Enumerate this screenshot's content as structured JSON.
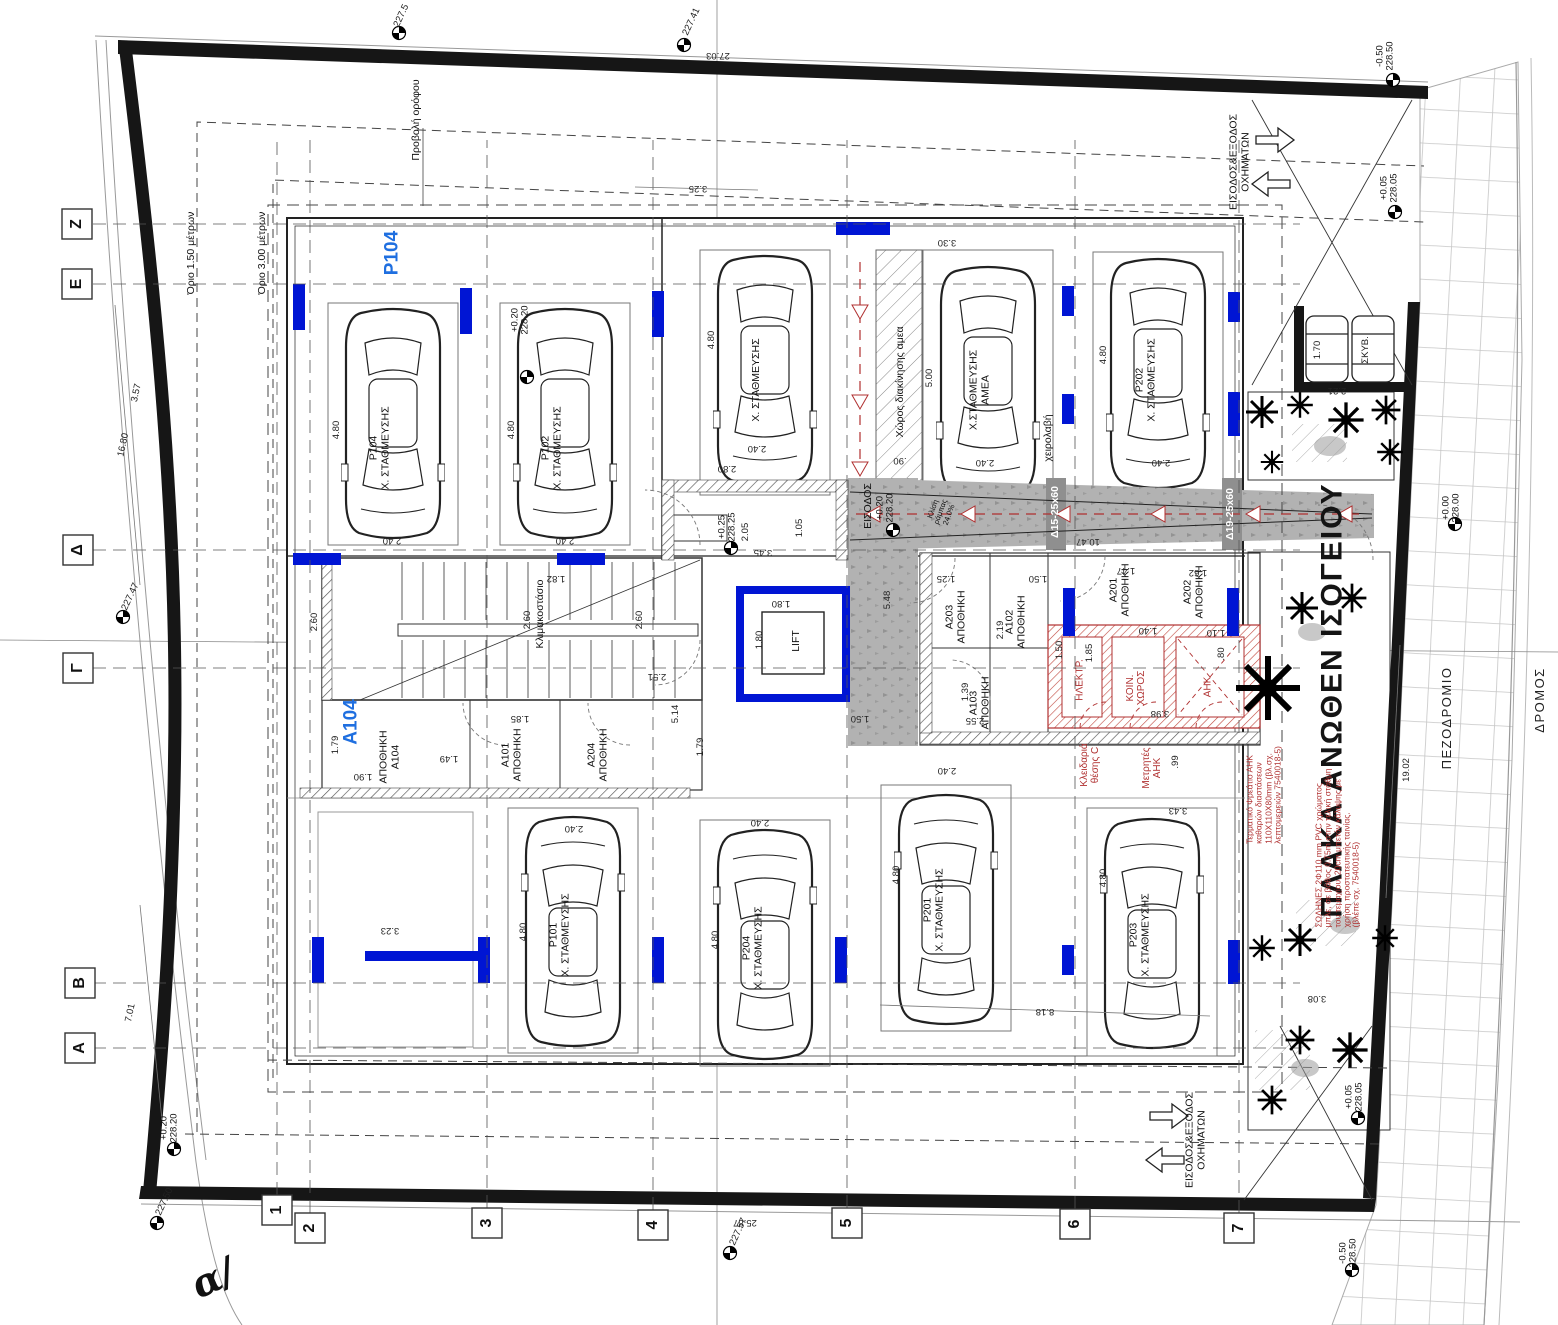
{
  "drawing_type": "architectural-ground-floor-parking-plan",
  "labels": [
    {
      "t": "Ζ",
      "x": 77,
      "y": 224,
      "r": -90,
      "c": "a",
      "n": "grid-axis-z"
    },
    {
      "t": "Ε",
      "x": 77,
      "y": 284,
      "r": -90,
      "c": "a",
      "n": "grid-axis-e"
    },
    {
      "t": "Δ",
      "x": 78,
      "y": 550,
      "r": -90,
      "c": "a",
      "n": "grid-axis-d"
    },
    {
      "t": "Γ",
      "x": 78,
      "y": 668,
      "r": -90,
      "c": "a",
      "n": "grid-axis-g"
    },
    {
      "t": "Β",
      "x": 80,
      "y": 983,
      "r": -90,
      "c": "a",
      "n": "grid-axis-b"
    },
    {
      "t": "Α",
      "x": 80,
      "y": 1048,
      "r": -90,
      "c": "a",
      "n": "grid-axis-a"
    },
    {
      "t": "1",
      "x": 277,
      "y": 1210,
      "r": -90,
      "c": "a",
      "n": "grid-axis-1"
    },
    {
      "t": "2",
      "x": 310,
      "y": 1228,
      "r": -90,
      "c": "a",
      "n": "grid-axis-2"
    },
    {
      "t": "3",
      "x": 487,
      "y": 1223,
      "r": -90,
      "c": "a",
      "n": "grid-axis-3"
    },
    {
      "t": "4",
      "x": 653,
      "y": 1225,
      "r": -90,
      "c": "a",
      "n": "grid-axis-4"
    },
    {
      "t": "5",
      "x": 847,
      "y": 1223,
      "r": -90,
      "c": "a",
      "n": "grid-axis-5"
    },
    {
      "t": "6",
      "x": 1075,
      "y": 1224,
      "r": -90,
      "c": "a",
      "n": "grid-axis-6"
    },
    {
      "t": "7",
      "x": 1239,
      "y": 1228,
      "r": -90,
      "c": "a",
      "n": "grid-axis-7"
    },
    {
      "t": "Όριο 1.50 μέτρων",
      "x": 192,
      "y": 253,
      "r": -90,
      "c": "t",
      "n": "setback-1-50"
    },
    {
      "t": "Όριο 3.00 μέτρων",
      "x": 263,
      "y": 253,
      "r": -90,
      "c": "t",
      "n": "setback-3-00"
    },
    {
      "t": "Προβολή ορόφου",
      "x": 417,
      "y": 120,
      "r": -90,
      "c": "t",
      "n": "floor-projection"
    },
    {
      "t": "P104",
      "x": 393,
      "y": 253,
      "r": -90,
      "c": "b",
      "n": "unit-p104"
    },
    {
      "t": "A104",
      "x": 352,
      "y": 722,
      "r": -90,
      "c": "b",
      "n": "unit-a104"
    },
    {
      "t": "ΠΛΑΚΑ ΑΝΩΘΕΝ ΙΣΟΓΕΙΟΥ",
      "x": 1332,
      "y": 700,
      "r": -90,
      "c": "g",
      "n": "slab-above-ground-floor"
    },
    {
      "t": "ΠΕΖΟΔΡΟΜΙΟ",
      "x": 1447,
      "y": 718,
      "r": -90,
      "c": "t2",
      "n": "sidewalk-label"
    },
    {
      "t": "ΔΡΟΜΟΣ",
      "x": 1540,
      "y": 700,
      "r": -90,
      "c": "t2",
      "n": "road-label"
    },
    {
      "t": "α/",
      "x": 213,
      "y": 1278,
      "r": -25,
      "c": "i",
      "n": "street-name-fragment"
    },
    {
      "t": "ΕΙΣΟΔΟΣ&ΕΞΟΔΟΣ\nΟΧΗΜΑΤΩΝ",
      "x": 1240,
      "y": 162,
      "r": -90,
      "c": "t",
      "n": "vehicle-entry-exit-top"
    },
    {
      "t": "ΕΙΣΟΔΟΣ&ΕΞΟΔΟΣ\nΟΧΗΜΑΤΩΝ",
      "x": 1196,
      "y": 1140,
      "r": -90,
      "c": "t",
      "n": "vehicle-entry-exit-bottom"
    },
    {
      "t": "ΕΙΣΟΔΟΣ",
      "x": 869,
      "y": 506,
      "r": -90,
      "c": "t",
      "n": "entrance-label"
    },
    {
      "t": "Κλιμακοστάσιο",
      "x": 541,
      "y": 614,
      "r": -90,
      "c": "t",
      "n": "staircase-label"
    },
    {
      "t": "LIFT",
      "x": 797,
      "y": 641,
      "r": -90,
      "c": "t",
      "n": "lift-label"
    },
    {
      "t": "χειρολαβή",
      "x": 1049,
      "y": 438,
      "r": -90,
      "c": "t",
      "n": "handrail-label"
    },
    {
      "t": "Χώρος διακίνησης αμεα",
      "x": 901,
      "y": 382,
      "r": -90,
      "c": "t",
      "n": "amea-maneuver-zone"
    },
    {
      "t": "Κλίση\nράμπας\n24.0%",
      "x": 941,
      "y": 512,
      "r": -70,
      "c": "xs",
      "n": "ramp-slope"
    },
    {
      "t": "Δ15-25x60",
      "x": 1056,
      "y": 512,
      "r": -90,
      "c": "w",
      "n": "beam-d15"
    },
    {
      "t": "Δ19-25x60",
      "x": 1231,
      "y": 514,
      "r": -90,
      "c": "w",
      "n": "beam-d19"
    },
    {
      "t": "P104\nΧ. ΣΤΑΘΜΕΥΣΗΣ",
      "x": 380,
      "y": 448,
      "r": -90,
      "c": "t",
      "n": "parking-p104"
    },
    {
      "t": "P102\nΧ. ΣΤΑΘΜΕΥΣΗΣ",
      "x": 552,
      "y": 448,
      "r": -90,
      "c": "t",
      "n": "parking-p102"
    },
    {
      "t": "Χ. ΣΤΑΘΜΕΥΣΗΣ",
      "x": 757,
      "y": 380,
      "r": -90,
      "c": "t",
      "n": "parking-p103"
    },
    {
      "t": "Χ.ΣΤΑΘΜΕΥΣΗΣ\nΑΜΕΑ",
      "x": 980,
      "y": 390,
      "r": -90,
      "c": "t",
      "n": "parking-amea"
    },
    {
      "t": "P202\nΧ. ΣΤΑΘΜΕΥΣΗΣ",
      "x": 1146,
      "y": 380,
      "r": -90,
      "c": "t",
      "n": "parking-p202"
    },
    {
      "t": "P101\nΧ. ΣΤΑΘΜΕΥΣΗΣ",
      "x": 560,
      "y": 935,
      "r": -90,
      "c": "t",
      "n": "parking-p101"
    },
    {
      "t": "P204\nΧ. ΣΤΑΘΜΕΥΣΗΣ",
      "x": 753,
      "y": 948,
      "r": -90,
      "c": "t",
      "n": "parking-p204"
    },
    {
      "t": "P201\nΧ. ΣΤΑΘΜΕΥΣΗΣ",
      "x": 934,
      "y": 910,
      "r": -90,
      "c": "t",
      "n": "parking-p201"
    },
    {
      "t": "P203\nΧ. ΣΤΑΘΜΕΥΣΗΣ",
      "x": 1140,
      "y": 935,
      "r": -90,
      "c": "t",
      "n": "parking-p203"
    },
    {
      "t": "ΑΠΟΘΗΚΗ\nA104",
      "x": 390,
      "y": 757,
      "r": -90,
      "c": "t",
      "n": "storage-a104"
    },
    {
      "t": "A101\nΑΠΟΘΗΚΗ",
      "x": 512,
      "y": 755,
      "r": -90,
      "c": "t",
      "n": "storage-a101"
    },
    {
      "t": "A204\nΑΠΟΘΗΚΗ",
      "x": 598,
      "y": 755,
      "r": -90,
      "c": "t",
      "n": "storage-a204"
    },
    {
      "t": "A203\nΑΠΟΘΗΚΗ",
      "x": 956,
      "y": 617,
      "r": -90,
      "c": "t",
      "n": "storage-a203"
    },
    {
      "t": "A102\nΑΠΟΘΗΚΗ",
      "x": 1016,
      "y": 622,
      "r": -90,
      "c": "t",
      "n": "storage-a102"
    },
    {
      "t": "A103\nΑΠΟΘΗΚΗ",
      "x": 980,
      "y": 703,
      "r": -90,
      "c": "t",
      "n": "storage-a103"
    },
    {
      "t": "A201\nΑΠΟΘΗΚΗ",
      "x": 1120,
      "y": 590,
      "r": -90,
      "c": "t",
      "n": "storage-a201"
    },
    {
      "t": "A202\nΑΠΟΘΗΚΗ",
      "x": 1194,
      "y": 592,
      "r": -90,
      "c": "t",
      "n": "storage-a202"
    },
    {
      "t": "ΗΛΕΚΤΡ.",
      "x": 1080,
      "y": 680,
      "r": -90,
      "c": "r",
      "n": "room-electrical"
    },
    {
      "t": "ΚΟΙΝ.\nΧΩΡΟΣ",
      "x": 1136,
      "y": 688,
      "r": -90,
      "c": "r",
      "n": "room-common-space"
    },
    {
      "t": "ΑΗΚ",
      "x": 1208,
      "y": 687,
      "r": -90,
      "c": "r",
      "n": "room-ahk"
    },
    {
      "t": "Κλειδαριά\nθέσης C",
      "x": 1090,
      "y": 765,
      "r": -90,
      "c": "r",
      "n": "note-lock-position-c"
    },
    {
      "t": "Μετρητές\nΑΗΚ",
      "x": 1152,
      "y": 768,
      "r": -90,
      "c": "r",
      "n": "note-ahk-meters"
    },
    {
      "t": "Τερματικό Φρεάτιο ΑΗΚ\nκαθαρών διαστάσεων\n110X110X80mm (βλ.σχ.\nλεπτομερειών 7540018-5)",
      "x": 1264,
      "y": 795,
      "r": -90,
      "c": "rs",
      "n": "note-ahk-pit"
    },
    {
      "t": "ΣΩΛΗΝΕΣ 2Φ110 mm PVC χρώματος\nμπλε, σε βάθος 0.75m στην τελική στάθμη\nτου τεμαχίου, 20cm μπετόν κάλυψης με\nχρήση προστατευτικής ταινίας.\n(βλέπε σχ. 7540018-5)",
      "x": 1338,
      "y": 848,
      "r": -90,
      "c": "rs",
      "n": "note-pvc-pipes"
    },
    {
      "t": "1.70",
      "x": 1318,
      "y": 350,
      "r": -90,
      "c": "d"
    },
    {
      "t": "ΣΚΥΒ.",
      "x": 1366,
      "y": 350,
      "r": -90,
      "c": "d",
      "n": "bins-label"
    },
    {
      "t": "2.21",
      "x": 1337,
      "y": 390,
      "r": 180,
      "c": "d"
    },
    {
      "t": "27.03",
      "x": 718,
      "y": 55,
      "r": 180,
      "c": "d"
    },
    {
      "t": "3.25",
      "x": 698,
      "y": 188,
      "r": 180,
      "c": "d"
    },
    {
      "t": "3.30",
      "x": 947,
      "y": 242,
      "r": 180,
      "c": "d"
    },
    {
      "t": "16.80",
      "x": 124,
      "y": 445,
      "r": -78,
      "c": "d"
    },
    {
      "t": "3.57",
      "x": 137,
      "y": 393,
      "r": -78,
      "c": "d"
    },
    {
      "t": "7.01",
      "x": 131,
      "y": 1013,
      "r": -78,
      "c": "d"
    },
    {
      "t": "25.87",
      "x": 745,
      "y": 1222,
      "r": 180,
      "c": "d"
    },
    {
      "t": "8.18",
      "x": 1045,
      "y": 1011,
      "r": 180,
      "c": "d"
    },
    {
      "t": "19.02",
      "x": 1407,
      "y": 770,
      "r": -90,
      "c": "d"
    },
    {
      "t": "10.47",
      "x": 1088,
      "y": 541,
      "r": 180,
      "c": "d"
    },
    {
      "t": "4.80",
      "x": 337,
      "y": 430,
      "r": -90,
      "c": "d"
    },
    {
      "t": "2.40",
      "x": 392,
      "y": 540,
      "r": 180,
      "c": "d"
    },
    {
      "t": "4.80",
      "x": 512,
      "y": 430,
      "r": -90,
      "c": "d"
    },
    {
      "t": "2.40",
      "x": 565,
      "y": 540,
      "r": 180,
      "c": "d"
    },
    {
      "t": "4.80",
      "x": 712,
      "y": 340,
      "r": -90,
      "c": "d"
    },
    {
      "t": "2.40",
      "x": 757,
      "y": 448,
      "r": 180,
      "c": "d"
    },
    {
      "t": "2.80",
      "x": 727,
      "y": 468,
      "r": 180,
      "c": "d"
    },
    {
      "t": "5.00",
      "x": 930,
      "y": 378,
      "r": -90,
      "c": "d"
    },
    {
      "t": "2.40",
      "x": 985,
      "y": 462,
      "r": 180,
      "c": "d"
    },
    {
      "t": ".90",
      "x": 900,
      "y": 460,
      "r": 180,
      "c": "d"
    },
    {
      "t": "4.80",
      "x": 1104,
      "y": 355,
      "r": -90,
      "c": "d"
    },
    {
      "t": "2.40",
      "x": 1161,
      "y": 462,
      "r": 180,
      "c": "d"
    },
    {
      "t": "4.80",
      "x": 524,
      "y": 932,
      "r": -90,
      "c": "d"
    },
    {
      "t": "2.40",
      "x": 574,
      "y": 828,
      "r": 180,
      "c": "d"
    },
    {
      "t": "4.80",
      "x": 716,
      "y": 940,
      "r": -90,
      "c": "d"
    },
    {
      "t": "2.40",
      "x": 760,
      "y": 822,
      "r": 180,
      "c": "d"
    },
    {
      "t": "4.80",
      "x": 897,
      "y": 875,
      "r": -90,
      "c": "d"
    },
    {
      "t": "2.40",
      "x": 947,
      "y": 770,
      "r": 180,
      "c": "d"
    },
    {
      "t": "4.80",
      "x": 1104,
      "y": 878,
      "r": -90,
      "c": "d"
    },
    {
      "t": "3.43",
      "x": 1178,
      "y": 810,
      "r": 180,
      "c": "d"
    },
    {
      "t": "3.23",
      "x": 390,
      "y": 930,
      "r": 180,
      "c": "d"
    },
    {
      "t": "3.08",
      "x": 1317,
      "y": 998,
      "r": 180,
      "c": "d"
    },
    {
      "t": "2.60",
      "x": 315,
      "y": 622,
      "r": -90,
      "c": "d"
    },
    {
      "t": "2.60",
      "x": 528,
      "y": 620,
      "r": -90,
      "c": "d"
    },
    {
      "t": "2.60",
      "x": 640,
      "y": 620,
      "r": -90,
      "c": "d"
    },
    {
      "t": "1.82",
      "x": 556,
      "y": 578,
      "r": 180,
      "c": "d"
    },
    {
      "t": "2.51",
      "x": 657,
      "y": 676,
      "r": 180,
      "c": "d"
    },
    {
      "t": "5.14",
      "x": 676,
      "y": 714,
      "r": -90,
      "c": "d"
    },
    {
      "t": "1.80",
      "x": 781,
      "y": 603,
      "r": 180,
      "c": "d"
    },
    {
      "t": "1.80",
      "x": 760,
      "y": 640,
      "r": -90,
      "c": "d"
    },
    {
      "t": "1.79",
      "x": 336,
      "y": 745,
      "r": -90,
      "c": "d"
    },
    {
      "t": "1.49",
      "x": 449,
      "y": 758,
      "r": 180,
      "c": "d"
    },
    {
      "t": "1.90",
      "x": 363,
      "y": 776,
      "r": 180,
      "c": "d"
    },
    {
      "t": "1.85",
      "x": 520,
      "y": 718,
      "r": 180,
      "c": "d"
    },
    {
      "t": "1.79",
      "x": 701,
      "y": 747,
      "r": -90,
      "c": "d"
    },
    {
      "t": "1.25",
      "x": 946,
      "y": 578,
      "r": 180,
      "c": "d"
    },
    {
      "t": "1.50",
      "x": 1038,
      "y": 578,
      "r": 180,
      "c": "d"
    },
    {
      "t": "1.47",
      "x": 1126,
      "y": 570,
      "r": 180,
      "c": "d"
    },
    {
      "t": "1.62",
      "x": 1198,
      "y": 572,
      "r": 180,
      "c": "d"
    },
    {
      "t": "2.19",
      "x": 1001,
      "y": 630,
      "r": -90,
      "c": "d"
    },
    {
      "t": "1.39",
      "x": 966,
      "y": 692,
      "r": -90,
      "c": "d"
    },
    {
      "t": "2.55",
      "x": 975,
      "y": 720,
      "r": 180,
      "c": "d"
    },
    {
      "t": "1.50",
      "x": 1060,
      "y": 650,
      "r": -90,
      "c": "d"
    },
    {
      "t": "1.85",
      "x": 1090,
      "y": 653,
      "r": -90,
      "c": "d"
    },
    {
      "t": "1.40",
      "x": 1148,
      "y": 630,
      "r": 180,
      "c": "d"
    },
    {
      "t": "1.10",
      "x": 1216,
      "y": 632,
      "r": 180,
      "c": "d"
    },
    {
      "t": ".80",
      "x": 1222,
      "y": 654,
      "r": -90,
      "c": "d"
    },
    {
      "t": "3.98",
      "x": 1160,
      "y": 713,
      "r": 180,
      "c": "d"
    },
    {
      "t": ".99",
      "x": 1176,
      "y": 762,
      "r": -90,
      "c": "d"
    },
    {
      "t": "3.45",
      "x": 763,
      "y": 552,
      "r": 180,
      "c": "d"
    },
    {
      "t": "2.05",
      "x": 746,
      "y": 532,
      "r": -90,
      "c": "d"
    },
    {
      "t": "1.05",
      "x": 800,
      "y": 528,
      "r": -90,
      "c": "d"
    },
    {
      "t": "5.48",
      "x": 888,
      "y": 600,
      "r": -90,
      "c": "d"
    },
    {
      "t": "1.50",
      "x": 860,
      "y": 718,
      "r": 180,
      "c": "d"
    },
    {
      "t": "+0.20\n228.20",
      "x": 521,
      "y": 320,
      "r": -90,
      "c": "v",
      "n": "level-228-20"
    },
    {
      "t": "+0.25\n228.25",
      "x": 728,
      "y": 527,
      "r": -90,
      "c": "v",
      "n": "level-228-25"
    },
    {
      "t": "+0.20\n228.20",
      "x": 886,
      "y": 508,
      "r": -90,
      "c": "v",
      "n": "level-228-20-entry"
    },
    {
      "t": "+0.20\n228.20",
      "x": 170,
      "y": 1128,
      "r": -90,
      "c": "v",
      "n": "level-228-20-sw"
    },
    {
      "t": "-0.50\n228.50",
      "x": 1386,
      "y": 56,
      "r": -90,
      "c": "v",
      "n": "level-228-50-ne"
    },
    {
      "t": "+0.05\n228.05",
      "x": 1390,
      "y": 188,
      "r": -90,
      "c": "v",
      "n": "level-228-05-ne"
    },
    {
      "t": "+0.00\n228.00",
      "x": 1452,
      "y": 508,
      "r": -90,
      "c": "v",
      "n": "level-228-00"
    },
    {
      "t": "+0.05\n228.05",
      "x": 1355,
      "y": 1097,
      "r": -90,
      "c": "v",
      "n": "level-228-05-se"
    },
    {
      "t": "-0.50\n228.50",
      "x": 1349,
      "y": 1253,
      "r": -90,
      "c": "v",
      "n": "level-228-50-se"
    },
    {
      "t": "227.5",
      "x": 402,
      "y": 16,
      "r": -65,
      "c": "d",
      "n": "spot-227-5"
    },
    {
      "t": "227.41",
      "x": 692,
      "y": 22,
      "r": -65,
      "c": "d",
      "n": "spot-227-41"
    },
    {
      "t": "227.47",
      "x": 131,
      "y": 597,
      "r": -65,
      "c": "d",
      "n": "spot-227-47"
    },
    {
      "t": "227.50",
      "x": 165,
      "y": 1202,
      "r": -65,
      "c": "d",
      "n": "spot-227-50"
    },
    {
      "t": "227.57",
      "x": 739,
      "y": 1232,
      "r": -65,
      "c": "d",
      "n": "spot-227-57"
    }
  ]
}
